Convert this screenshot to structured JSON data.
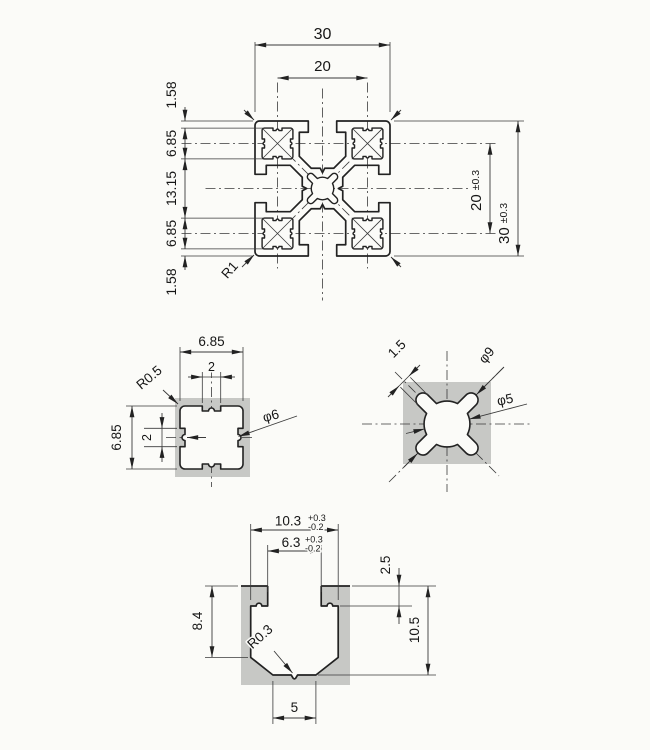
{
  "colors": {
    "background": "#fbfbf8",
    "material": "#c7c8c5",
    "line": "#222222",
    "dim_line": "#3a3a3a"
  },
  "main_view": {
    "dim_width_outer": "30",
    "dim_width_centers": "20",
    "dim_left_wall_top": "1.58",
    "dim_left_block_top": "6.85",
    "dim_left_center": "13.15",
    "dim_left_block_bottom": "6.85",
    "dim_left_wall_bottom": "1.58",
    "dim_height_centers": "20",
    "dim_height_centers_tol": "±0.3",
    "dim_height_outer": "30",
    "dim_height_outer_tol": "±0.3",
    "corner_radius": "R1"
  },
  "corner_hole_view": {
    "dim_width": "6.85",
    "dim_tab_width": "2",
    "corner_radius": "R0.5",
    "dim_height": "6.85",
    "dim_tab_height": "2",
    "bore_diameter": "φ6"
  },
  "center_hub_view": {
    "dim_arm_width": "1.5",
    "dim_outer_diameter": "φ9",
    "dim_core_diameter": "φ5"
  },
  "slot_view": {
    "dim_slot_width": "10.3",
    "slot_width_tol_plus": "+0.3",
    "slot_width_tol_minus": "-0.2",
    "dim_opening_width": "6.3",
    "opening_tol_plus": "+0.3",
    "opening_tol_minus": "-0.2",
    "dim_lip_depth": "2.5",
    "dim_side_depth": "8.4",
    "dim_total_depth": "10.5",
    "bottom_radius": "R0.3",
    "dim_bottom_flat": "5"
  }
}
